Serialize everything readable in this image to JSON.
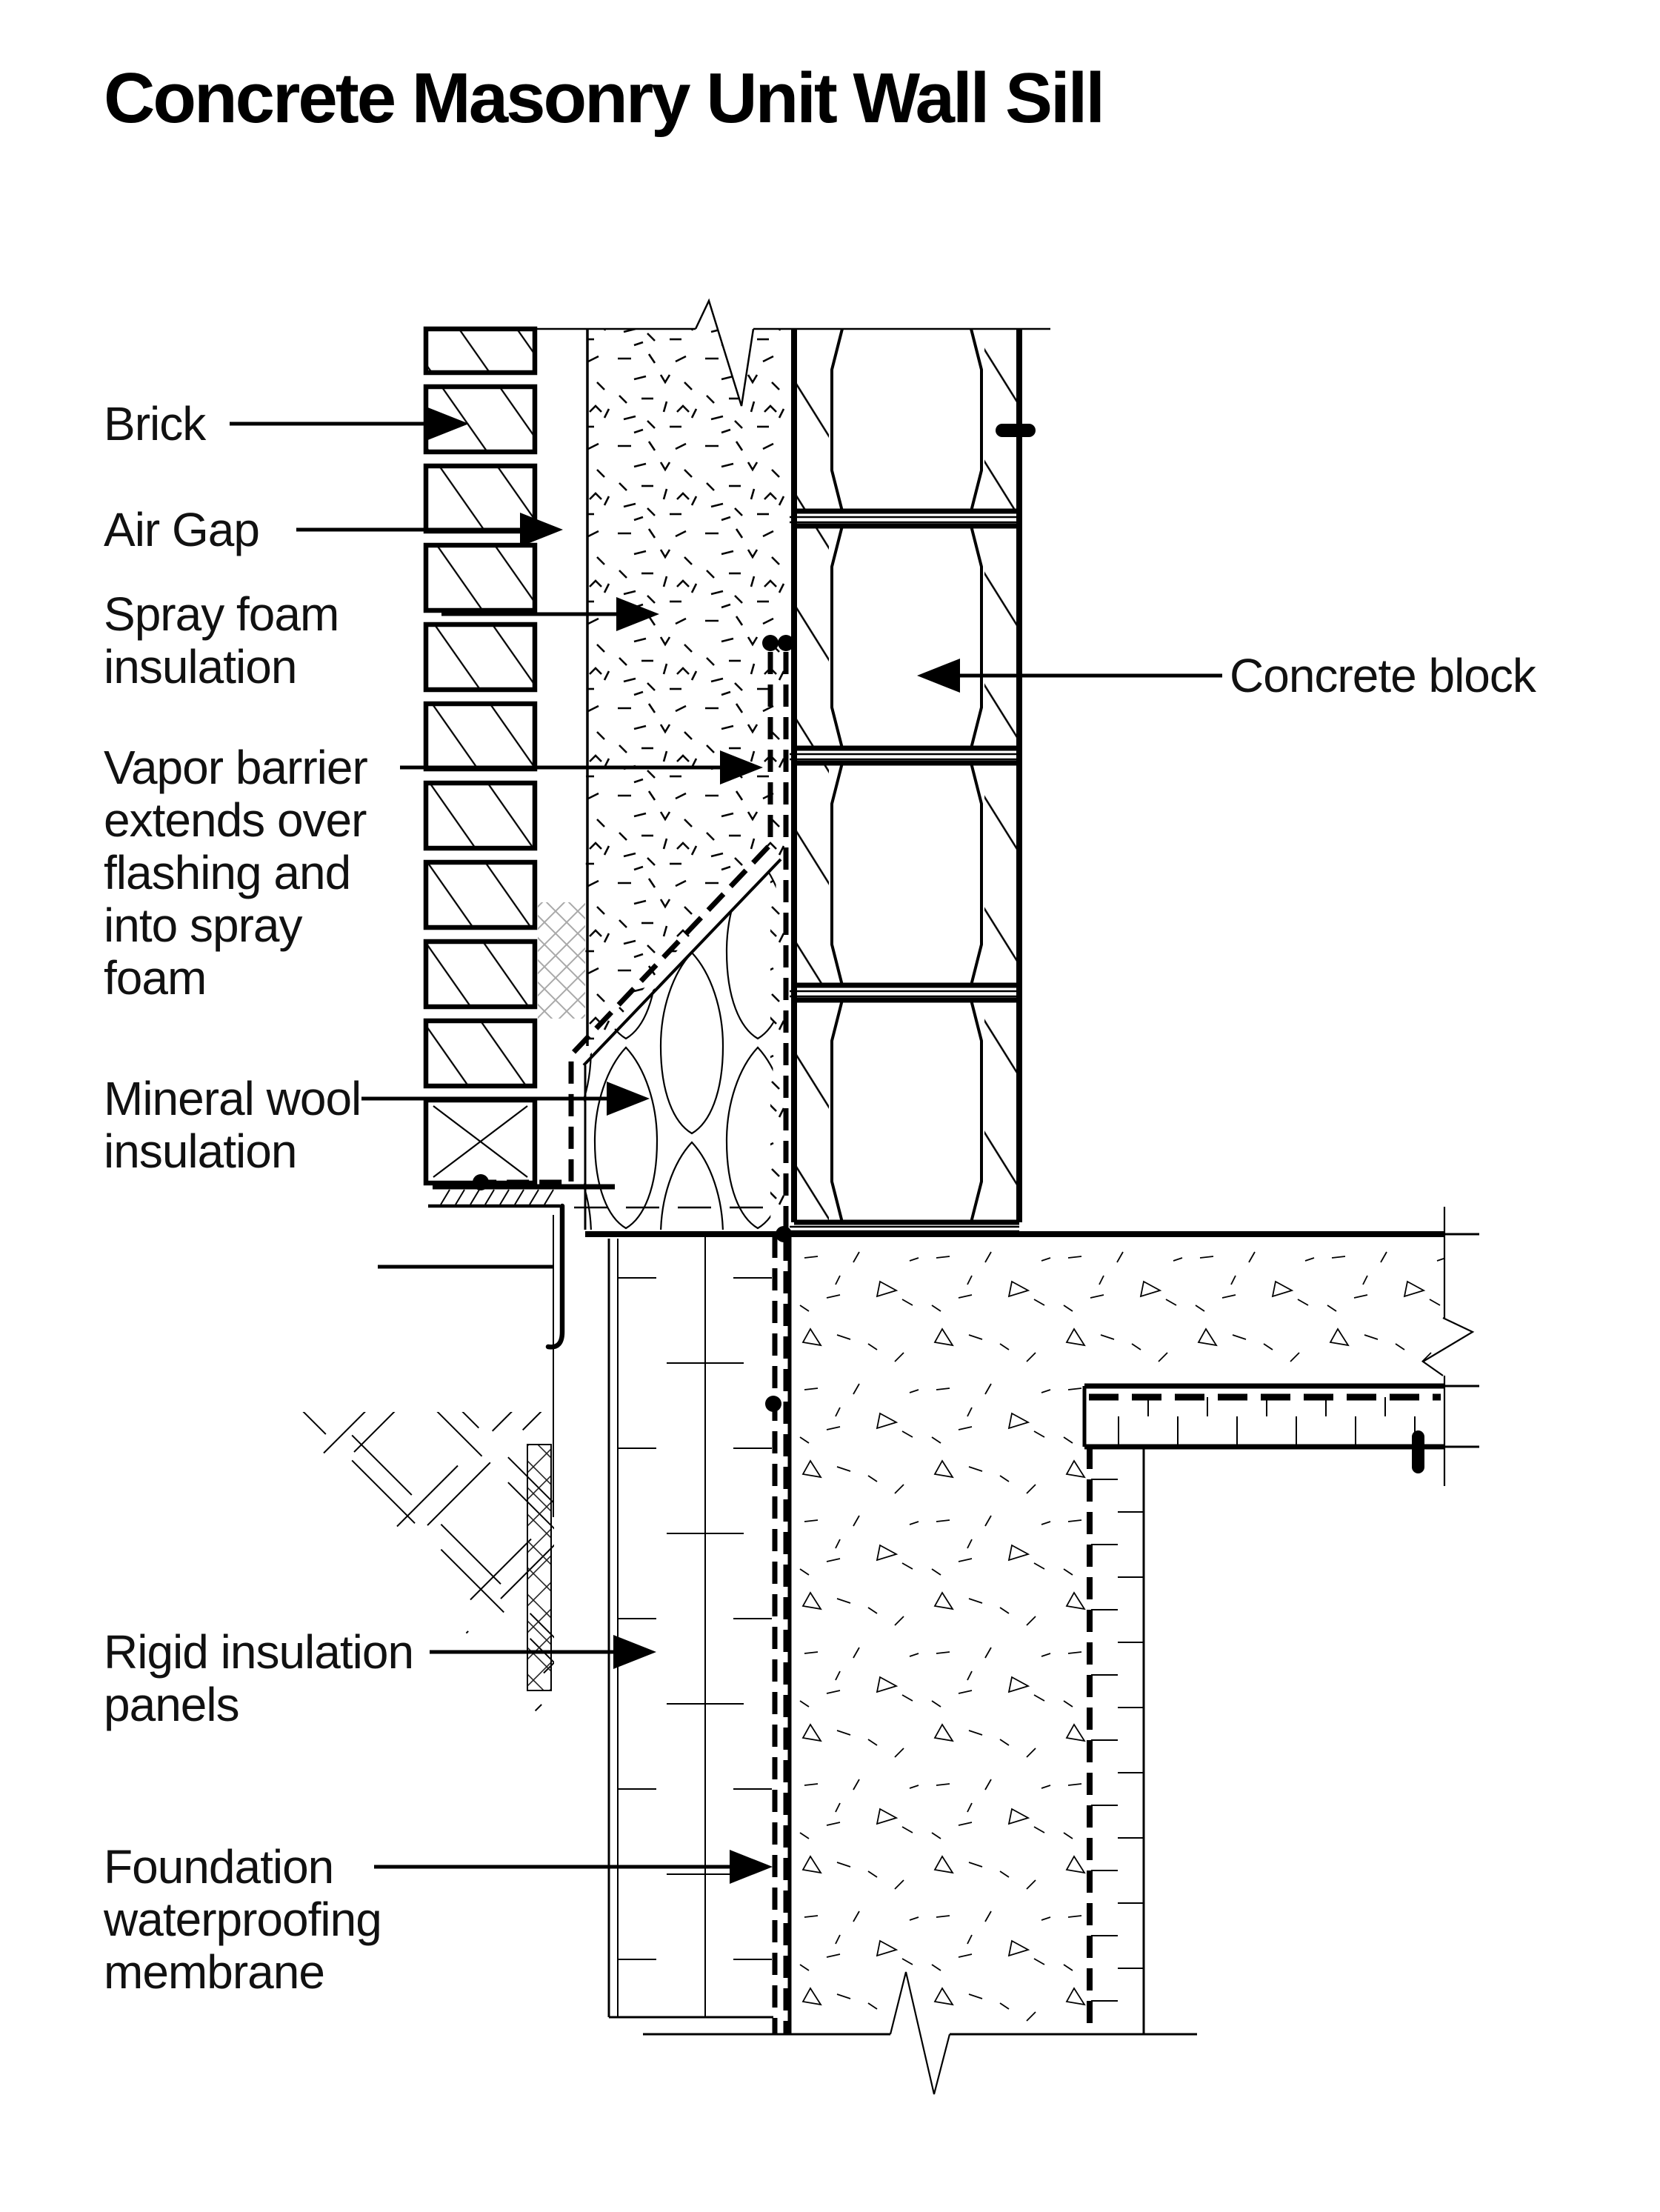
{
  "title": "Concrete Masonry Unit Wall Sill",
  "labels": {
    "brick": {
      "lines": [
        "Brick"
      ]
    },
    "air_gap": {
      "lines": [
        "Air Gap"
      ]
    },
    "spray_foam": {
      "lines": [
        "Spray foam",
        "insulation"
      ]
    },
    "vapor_barrier": {
      "lines": [
        "Vapor barrier",
        "extends over",
        "flashing and",
        "into spray",
        "foam"
      ]
    },
    "mineral_wool": {
      "lines": [
        "Mineral wool",
        "insulation"
      ]
    },
    "concrete_block": {
      "lines": [
        "Concrete block"
      ]
    },
    "rigid_insulation": {
      "lines": [
        "Rigid insulation",
        "panels"
      ]
    },
    "foundation_membrane": {
      "lines": [
        "Foundation",
        "waterproofing",
        "membrane"
      ]
    }
  },
  "colors": {
    "ink": "#000000",
    "paper": "#ffffff",
    "mesh_gray": "#a9a9a9"
  }
}
